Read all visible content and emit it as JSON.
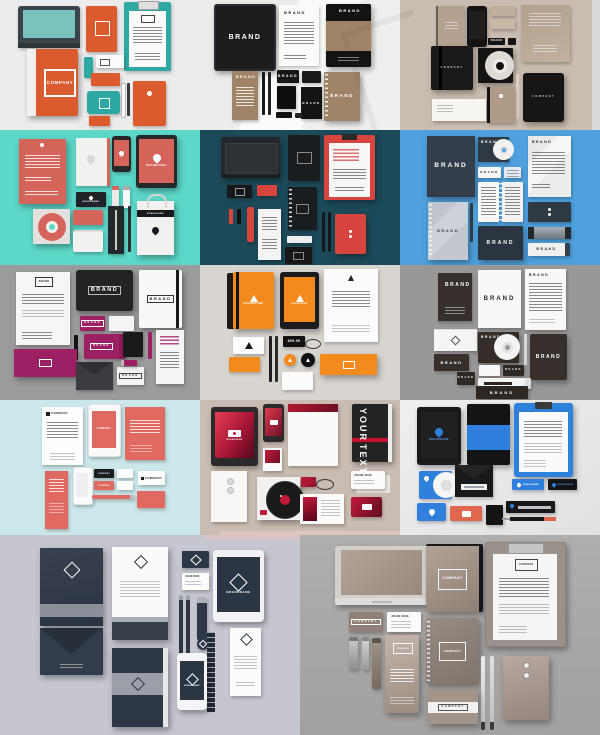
{
  "image": {
    "description": "Collage of 14 corporate identity / branding stationery mockup scenes arranged in a grid",
    "grid": {
      "rows": 5,
      "cells": [
        3,
        3,
        3,
        3,
        2
      ]
    }
  },
  "labels": {
    "brand": "BRAND",
    "company": "COMPANY",
    "brandname": "BRANDNAME",
    "your": "YOUR",
    "text": "TEXT",
    "john_doe": "JOHN DOE",
    "price": "$99.99"
  },
  "palette": {
    "orange": "#DC5B2E",
    "teal": "#2EA8A3",
    "turquoise_bg": "#5CD7C8",
    "dark_teal_bg": "#1C4A58",
    "red": "#D8453E",
    "coral": "#E06A62",
    "blue_bg": "#4FA0DC",
    "navy": "#333E4A",
    "bright_blue": "#2F80DC",
    "magenta": "#9E2064",
    "orange2": "#F28A1E",
    "dark_brown": "#352E2B",
    "tan": "#A08468",
    "taupe_bg": "#C9BCB0",
    "red_grad": "#C21A3A",
    "navy2": "#2E3845",
    "lavender_bg": "#C5C6D0",
    "taupe": "#8F8177",
    "gray_bg": "#9B9B9B",
    "light_cyan_bg": "#CBE7E9"
  },
  "panels": [
    {
      "id": "p1",
      "name": "orange-teal-set",
      "bg": "#ECECEC"
    },
    {
      "id": "p2",
      "name": "black-tan-brand-set",
      "bg": "#F2F2F1"
    },
    {
      "id": "p3",
      "name": "beige-black-set",
      "bg": "#C9BCB0"
    },
    {
      "id": "p4",
      "name": "coral-on-turquoise-set",
      "bg": "#5CD7C8"
    },
    {
      "id": "p5",
      "name": "black-red-on-darkteal-set",
      "bg": "#1C4A58"
    },
    {
      "id": "p6",
      "name": "navy-brand-on-blue-set",
      "bg": "#4FA0DC"
    },
    {
      "id": "p7",
      "name": "magenta-black-set",
      "bg": "#9B9B9B"
    },
    {
      "id": "p8",
      "name": "orange-black-set",
      "bg": "#D8D4D0"
    },
    {
      "id": "p9",
      "name": "dark-brown-white-brand-set",
      "bg": "#9A9896"
    },
    {
      "id": "p10",
      "name": "coral-company-on-cyan-set",
      "bg": "#CBE7E9"
    },
    {
      "id": "p11",
      "name": "red-gradient-your-text-set",
      "bg": "#C9BCB2"
    },
    {
      "id": "p12",
      "name": "blue-black-brandname-set",
      "bg": "#E8E8E8"
    },
    {
      "id": "p13",
      "name": "navy-diamond-brandname-set",
      "bg": "#C5C6D0"
    },
    {
      "id": "p14",
      "name": "taupe-company-set",
      "bg": "#A9A8A6"
    }
  ],
  "watermark": {
    "type": "faint-diagonal-mark"
  }
}
